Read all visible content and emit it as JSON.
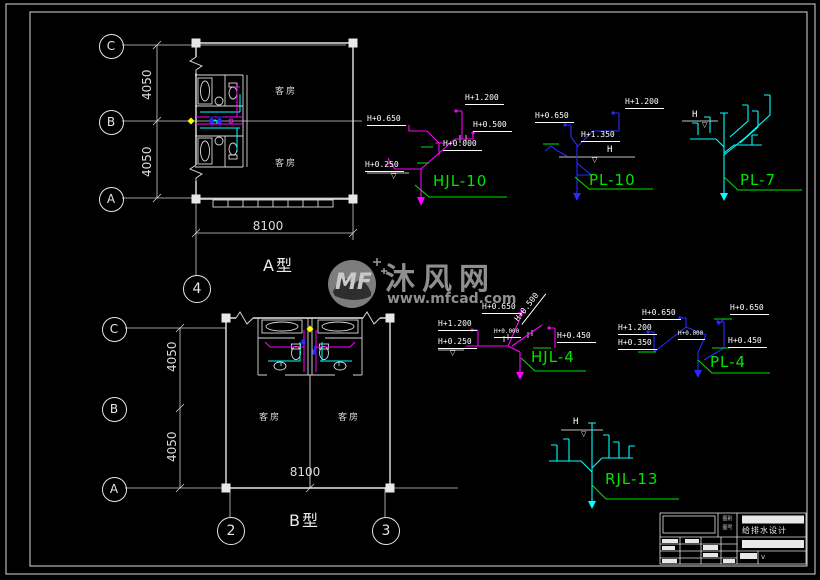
{
  "symbols": {
    "level": "▽"
  },
  "watermark": {
    "brand": "沐风网",
    "url": "www.mfcad.com",
    "logo": "MF"
  },
  "plan_a": {
    "title": "A型",
    "bubble_c": "C",
    "bubble_b": "B",
    "bubble_a": "A",
    "bubble_4": "4",
    "dim_v1": "4050",
    "dim_v2": "4050",
    "dim_h": "8100",
    "room_top": "客房",
    "room_bottom": "客房"
  },
  "plan_b": {
    "title": "B型",
    "bubble_c": "C",
    "bubble_b": "B",
    "bubble_a": "A",
    "bubble_2": "2",
    "bubble_3": "3",
    "dim_v1": "4050",
    "dim_v2": "4050",
    "dim_h": "8100",
    "room_left": "客房",
    "room_right": "客房"
  },
  "risers": {
    "hjl10": {
      "name": "HJL-10",
      "h0650": "H+0.650",
      "h1200": "H+1.200",
      "h0500": "H+0.500",
      "h0000": "H+0.000",
      "h0250": "H+0.250"
    },
    "pl10": {
      "name": "PL-10",
      "h0650": "H+0.650",
      "h1200": "H+1.200",
      "h1350": "H+1.350",
      "h": "H"
    },
    "pl7": {
      "name": "PL-7",
      "h": "H"
    },
    "hjl4": {
      "name": "HJL-4",
      "h0650": "H+0.650",
      "h0500": "H+0.500",
      "h1200": "H+1.200",
      "h0250": "H+0.250",
      "h0450": "H+0.450",
      "h0000": "H+0.000"
    },
    "pl4": {
      "name": "PL-4",
      "h0650a": "H+0.650",
      "h0650b": "H+0.650",
      "h1200": "H+1.200",
      "h0350": "H+0.350",
      "h0450": "H+0.450",
      "h0000": "H+0.000"
    },
    "rjl13": {
      "name": "RJL-13",
      "h": "H"
    }
  },
  "titleblock": {
    "project": "给排水设计",
    "row1": "图别",
    "row2": "图号",
    "mark": "v"
  },
  "colors": {
    "pipe_hot": "#ff00ff",
    "pipe_waste": "#2a2aff",
    "pipe_cold": "#00ffff",
    "label_name": "#00e400",
    "lines": "#e0e0e0"
  }
}
